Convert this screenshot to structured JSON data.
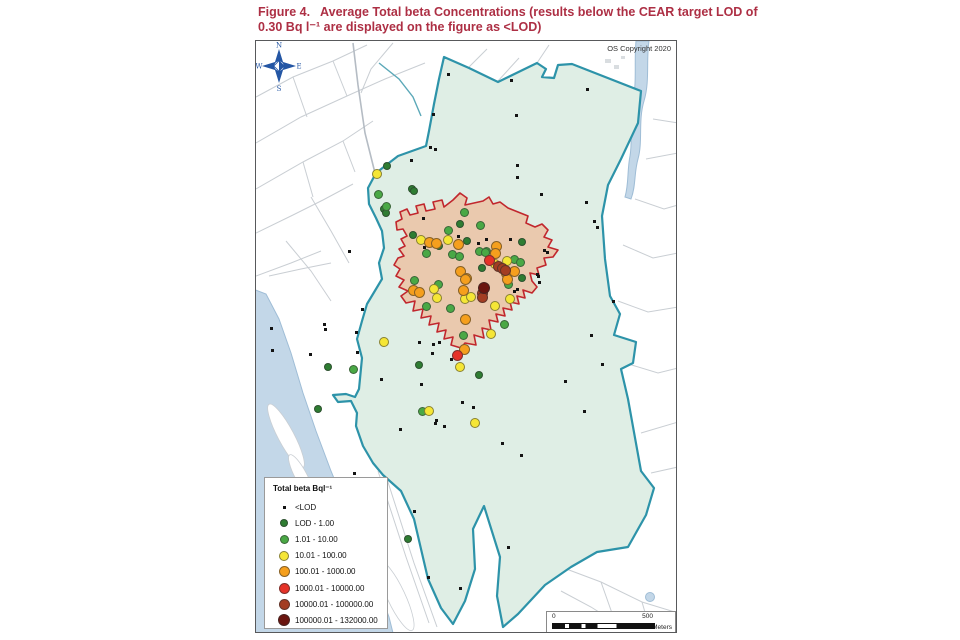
{
  "title": {
    "line1": "Figure 4.   Average Total beta Concentrations (results below the CEAR target LOD of",
    "line2": "0.30 Bq l⁻¹ are displayed on the figure as <LOD)",
    "color": "#ad2f44"
  },
  "map": {
    "copyright": "OS Copyright 2020",
    "compass": {
      "n": "N",
      "e": "E",
      "s": "S",
      "w": "W",
      "color": "#2456a4"
    },
    "scalebar": {
      "start": "0",
      "end": "500",
      "units": "Meters"
    },
    "colors": {
      "sea": "#c3d7e8",
      "estate_fill": "#dfeee5",
      "estate_border": "#2d93a9",
      "site_fill": "#eac9ae",
      "site_border": "#c1272d",
      "land_line": "#c9ced3"
    },
    "legend": {
      "title": "Total beta Bql⁻¹",
      "items": [
        {
          "key": "lod",
          "label": "<LOD",
          "color": "#141414",
          "size": 3,
          "shape": "square"
        },
        {
          "key": "lod_1",
          "label": "LOD - 1.00",
          "color": "#2e7d32",
          "size": 8,
          "shape": "circle"
        },
        {
          "key": "v1_10",
          "label": "1.01 - 10.00",
          "color": "#4aa845",
          "size": 9,
          "shape": "circle"
        },
        {
          "key": "v10_100",
          "label": "10.01 - 100.00",
          "color": "#f5e636",
          "size": 10,
          "shape": "circle"
        },
        {
          "key": "v100_1k",
          "label": "100.01 - 1000.00",
          "color": "#f59f1d",
          "size": 11,
          "shape": "circle"
        },
        {
          "key": "v1k_10k",
          "label": "1000.01 - 10000.00",
          "color": "#e53228",
          "size": 11,
          "shape": "circle"
        },
        {
          "key": "v10k_100k",
          "label": "10000.01 - 100000.00",
          "color": "#a33d22",
          "size": 11,
          "shape": "circle"
        },
        {
          "key": "v100k_132k",
          "label": "100000.01 - 132000.00",
          "color": "#6b150f",
          "size": 12,
          "shape": "circle"
        }
      ]
    },
    "points": {
      "lod": [
        [
          447,
          73
        ],
        [
          510,
          79
        ],
        [
          586,
          88
        ],
        [
          432,
          113
        ],
        [
          515,
          114
        ],
        [
          429,
          146
        ],
        [
          434,
          148
        ],
        [
          410,
          159
        ],
        [
          516,
          164
        ],
        [
          516,
          176
        ],
        [
          540,
          193
        ],
        [
          585,
          201
        ],
        [
          593,
          220
        ],
        [
          596,
          226
        ],
        [
          422,
          217
        ],
        [
          423,
          246
        ],
        [
          348,
          250
        ],
        [
          457,
          235
        ],
        [
          485,
          238
        ],
        [
          477,
          242
        ],
        [
          543,
          249
        ],
        [
          546,
          251
        ],
        [
          509,
          238
        ],
        [
          536,
          273
        ],
        [
          537,
          275
        ],
        [
          538,
          281
        ],
        [
          516,
          288
        ],
        [
          433,
          297
        ],
        [
          513,
          290
        ],
        [
          361,
          308
        ],
        [
          270,
          327
        ],
        [
          324,
          328
        ],
        [
          323,
          323
        ],
        [
          355,
          331
        ],
        [
          271,
          349
        ],
        [
          309,
          353
        ],
        [
          356,
          351
        ],
        [
          418,
          341
        ],
        [
          432,
          343
        ],
        [
          438,
          341
        ],
        [
          431,
          352
        ],
        [
          450,
          358
        ],
        [
          601,
          363
        ],
        [
          564,
          380
        ],
        [
          420,
          383
        ],
        [
          380,
          378
        ],
        [
          583,
          410
        ],
        [
          461,
          401
        ],
        [
          472,
          406
        ],
        [
          435,
          419
        ],
        [
          443,
          425
        ],
        [
          434,
          422
        ],
        [
          399,
          428
        ],
        [
          501,
          442
        ],
        [
          520,
          454
        ],
        [
          590,
          334
        ],
        [
          612,
          300
        ],
        [
          353,
          472
        ],
        [
          413,
          510
        ],
        [
          507,
          546
        ],
        [
          427,
          576
        ],
        [
          459,
          587
        ]
      ],
      "lod_1": [
        [
          386,
          165
        ],
        [
          411,
          188
        ],
        [
          413,
          190
        ],
        [
          383,
          208
        ],
        [
          385,
          212
        ],
        [
          412,
          234
        ],
        [
          438,
          245
        ],
        [
          459,
          223
        ],
        [
          466,
          240
        ],
        [
          481,
          267
        ],
        [
          521,
          241
        ],
        [
          521,
          277
        ],
        [
          327,
          366
        ],
        [
          317,
          408
        ],
        [
          418,
          364
        ],
        [
          407,
          538
        ],
        [
          478,
          374
        ]
      ],
      "v1_10": [
        [
          377,
          193
        ],
        [
          385,
          205
        ],
        [
          463,
          211
        ],
        [
          447,
          229
        ],
        [
          425,
          252
        ],
        [
          451,
          253
        ],
        [
          458,
          255
        ],
        [
          478,
          250
        ],
        [
          485,
          250
        ],
        [
          437,
          283
        ],
        [
          413,
          279
        ],
        [
          425,
          305
        ],
        [
          449,
          307
        ],
        [
          479,
          224
        ],
        [
          484,
          251
        ],
        [
          513,
          258
        ],
        [
          519,
          261
        ],
        [
          507,
          283
        ],
        [
          503,
          323
        ],
        [
          352,
          368
        ],
        [
          421,
          410
        ],
        [
          462,
          334
        ]
      ],
      "v10_100": [
        [
          376,
          173
        ],
        [
          420,
          239
        ],
        [
          447,
          239
        ],
        [
          433,
          288
        ],
        [
          436,
          297
        ],
        [
          464,
          298
        ],
        [
          470,
          296
        ],
        [
          494,
          263
        ],
        [
          506,
          260
        ],
        [
          494,
          305
        ],
        [
          509,
          298
        ],
        [
          490,
          333
        ],
        [
          383,
          341
        ],
        [
          459,
          366
        ],
        [
          428,
          410
        ],
        [
          474,
          422
        ]
      ],
      "v100_1k": [
        [
          428,
          241
        ],
        [
          435,
          242
        ],
        [
          457,
          243
        ],
        [
          495,
          245
        ],
        [
          494,
          252
        ],
        [
          459,
          270
        ],
        [
          465,
          277
        ],
        [
          464,
          278
        ],
        [
          462,
          289
        ],
        [
          412,
          289
        ],
        [
          418,
          291
        ],
        [
          505,
          272
        ],
        [
          506,
          278
        ],
        [
          513,
          270
        ],
        [
          464,
          318
        ],
        [
          463,
          348
        ]
      ],
      "v1k_10k": [
        [
          488,
          259
        ],
        [
          456,
          354
        ]
      ],
      "v10k_100k": [
        [
          497,
          265
        ],
        [
          501,
          267
        ],
        [
          504,
          269
        ],
        [
          481,
          292
        ],
        [
          481,
          296
        ]
      ],
      "v100k_132k": [
        [
          483,
          287
        ]
      ]
    }
  }
}
